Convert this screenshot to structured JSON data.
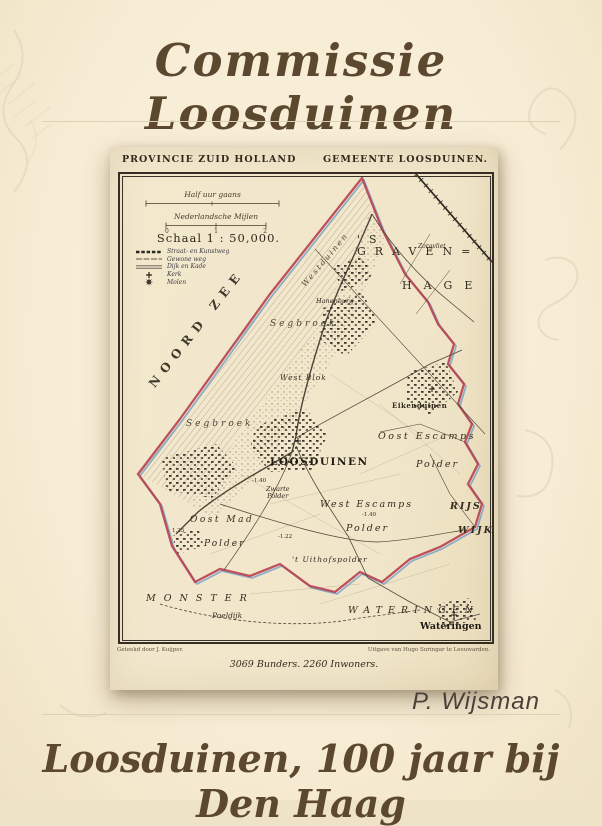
{
  "page": {
    "title": "Commissie Loosduinen",
    "author": "P. Wijsman",
    "subtitle": "Loosduinen, 100 jaar bij Den Haag"
  },
  "colors": {
    "background": "#f7ecd4",
    "ink": "#5b482f",
    "map_paper": "#f1e6ca",
    "boundary_red": "#b8404f",
    "boundary_blue": "#7fa6c9"
  },
  "map": {
    "header_left": "PROVINCIE ZUID HOLLAND",
    "header_right": "GEMEENTE LOOSDUINEN.",
    "scale": {
      "bar1_label": "Half uur gaans",
      "bar2_label": "Nederlandsche Mijlen",
      "bar2_ticks": [
        "0",
        "1",
        "2"
      ],
      "schaal": "Schaal 1 : 50,000."
    },
    "legend": {
      "items": [
        {
          "symbol": "paved-road",
          "label": "Straat- en Kunstweg"
        },
        {
          "symbol": "plain-road",
          "label": "Gewone weg"
        },
        {
          "symbol": "dike",
          "label": "Dijk en Kade"
        },
        {
          "symbol": "church",
          "label": "Kerk"
        },
        {
          "symbol": "windmill",
          "label": "Molen"
        }
      ]
    },
    "labels": {
      "noord_zee": "NOORD ZEE",
      "sgraven": "'S GRAVEN=",
      "hage": "HAGE",
      "westduinen": "Westduinen",
      "hanenburg": "Hanenburg",
      "zorgvliet": "Zorgvliet",
      "segbroek_north": "Segbroek",
      "segbroek_south": "Segbroek",
      "west_blok": "West Blok",
      "eikenduinen": "Eikenduinen",
      "loosduinen": "LOOSDUINEN",
      "oost_escamps": "Oost Escamps",
      "oost_escamps_polder": "Polder",
      "west_escamps": "West Escamps",
      "west_escamps_polder": "Polder",
      "zwarte_polder": "Zwarte\nPolder",
      "oost_mad": "Oost Mad",
      "oost_mad_polder": "Polder",
      "uithofspolder": "'t Uithofspolder",
      "rijs": "RIJS",
      "wijk": "WIJK",
      "monster": "MONSTER",
      "poeldijk": "Poeldijk",
      "wateringen_region": "WATERINGEN",
      "wateringen_town": "Wateringen",
      "elev_140_a": "-1.40",
      "elev_140_b": "-1.40",
      "elev_122": "-1.22",
      "elev_125": "1.25"
    },
    "credits": {
      "left": "Geteekd door J. Kuijper.",
      "right": "Uitgave van Hugo Suringar te Leeuwarden."
    },
    "stats": "3069 Bunders. 2260 Inwoners."
  }
}
